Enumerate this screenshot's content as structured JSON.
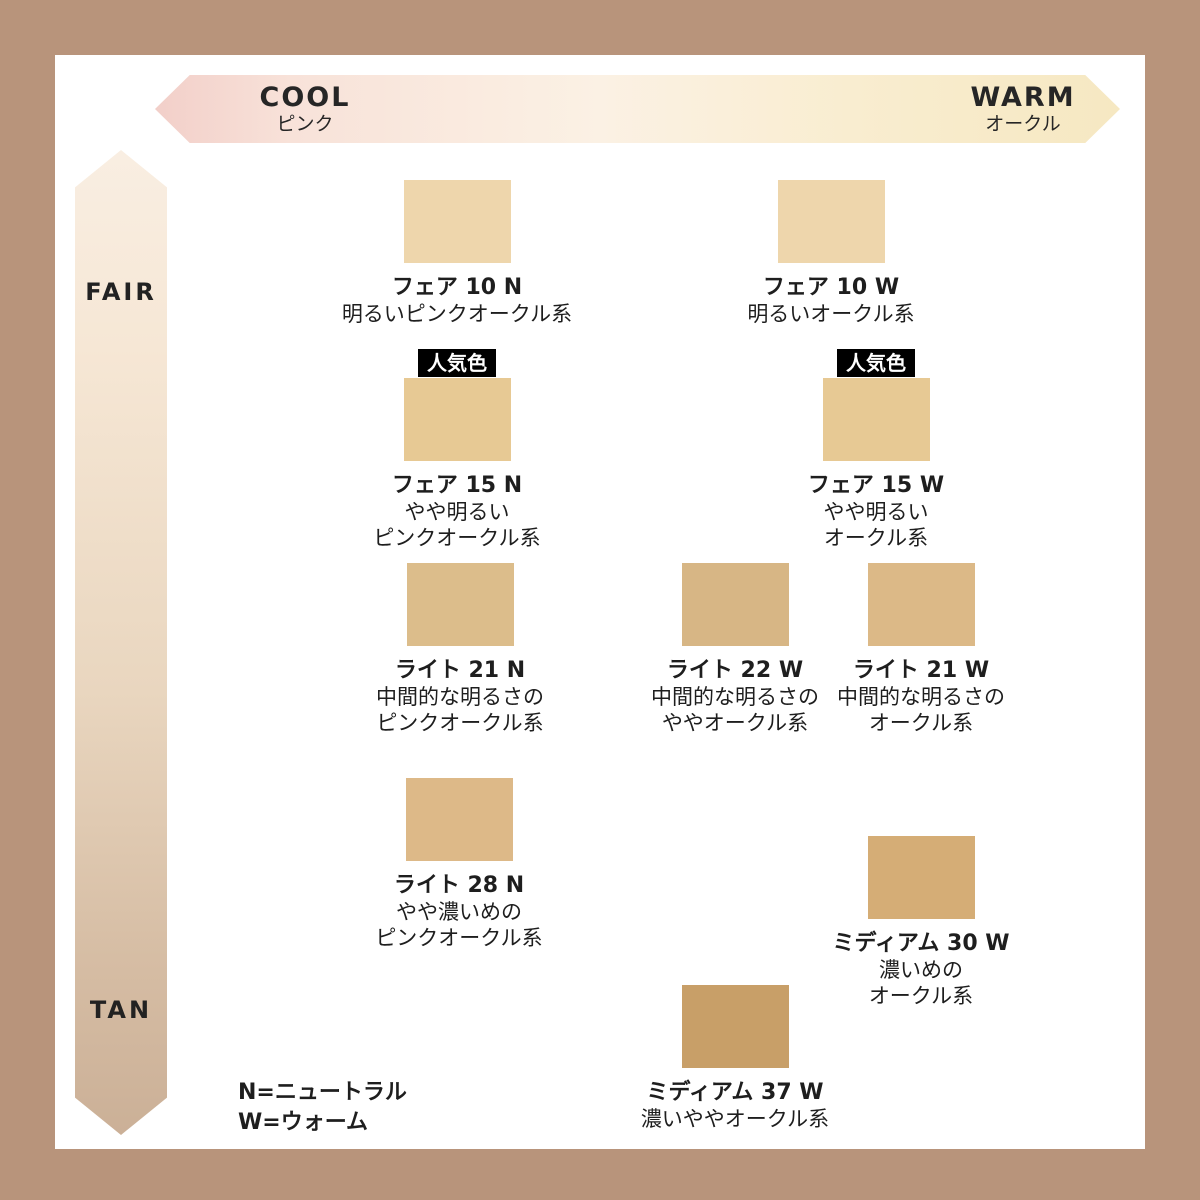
{
  "axes": {
    "horizontal": {
      "left_label": "COOL",
      "left_sublabel": "ピンク",
      "right_label": "WARM",
      "right_sublabel": "オークル"
    },
    "vertical": {
      "top_label": "FAIR",
      "bottom_label": "TAN"
    }
  },
  "popular_badge_label": "人気色",
  "legend": {
    "line1": "N=ニュートラル",
    "line2": "W=ウォーム"
  },
  "colors": {
    "frame": "#b8947b",
    "panel": "#ffffff",
    "badge_bg": "#000000",
    "badge_text": "#ffffff",
    "cool_gradient_start": "#f2cfc9",
    "warm_gradient_end": "#f6e8c2",
    "vertical_gradient_top": "#f9eee2",
    "vertical_gradient_bottom": "#cbb097"
  },
  "shades": [
    {
      "name": "フェア 10 N",
      "desc1": "明るいピンクオークル系",
      "desc2": "",
      "color": "#eed6ac",
      "popular": false
    },
    {
      "name": "フェア 10 W",
      "desc1": "明るいオークル系",
      "desc2": "",
      "color": "#eed6ac",
      "popular": false
    },
    {
      "name": "フェア 15 N",
      "desc1": "やや明るい",
      "desc2": "ピンクオークル系",
      "color": "#e7c994",
      "popular": true
    },
    {
      "name": "フェア 15 W",
      "desc1": "やや明るい",
      "desc2": "オークル系",
      "color": "#e7c994",
      "popular": true
    },
    {
      "name": "ライト 21 N",
      "desc1": "中間的な明るさの",
      "desc2": "ピンクオークル系",
      "color": "#dcbd8b",
      "popular": false
    },
    {
      "name": "ライト 22 W",
      "desc1": "中間的な明るさの",
      "desc2": "ややオークル系",
      "color": "#d7b685",
      "popular": false
    },
    {
      "name": "ライト 21 W",
      "desc1": "中間的な明るさの",
      "desc2": "オークル系",
      "color": "#dcb987",
      "popular": false
    },
    {
      "name": "ライト 28 N",
      "desc1": "やや濃いめの",
      "desc2": "ピンクオークル系",
      "color": "#ddb988",
      "popular": false
    },
    {
      "name": "ミディアム 30 W",
      "desc1": "濃いめの",
      "desc2": "オークル系",
      "color": "#d5ad76",
      "popular": false
    },
    {
      "name": "ミディアム 37 W",
      "desc1": "濃いややオークル系",
      "desc2": "",
      "color": "#c89f68",
      "popular": false
    }
  ]
}
